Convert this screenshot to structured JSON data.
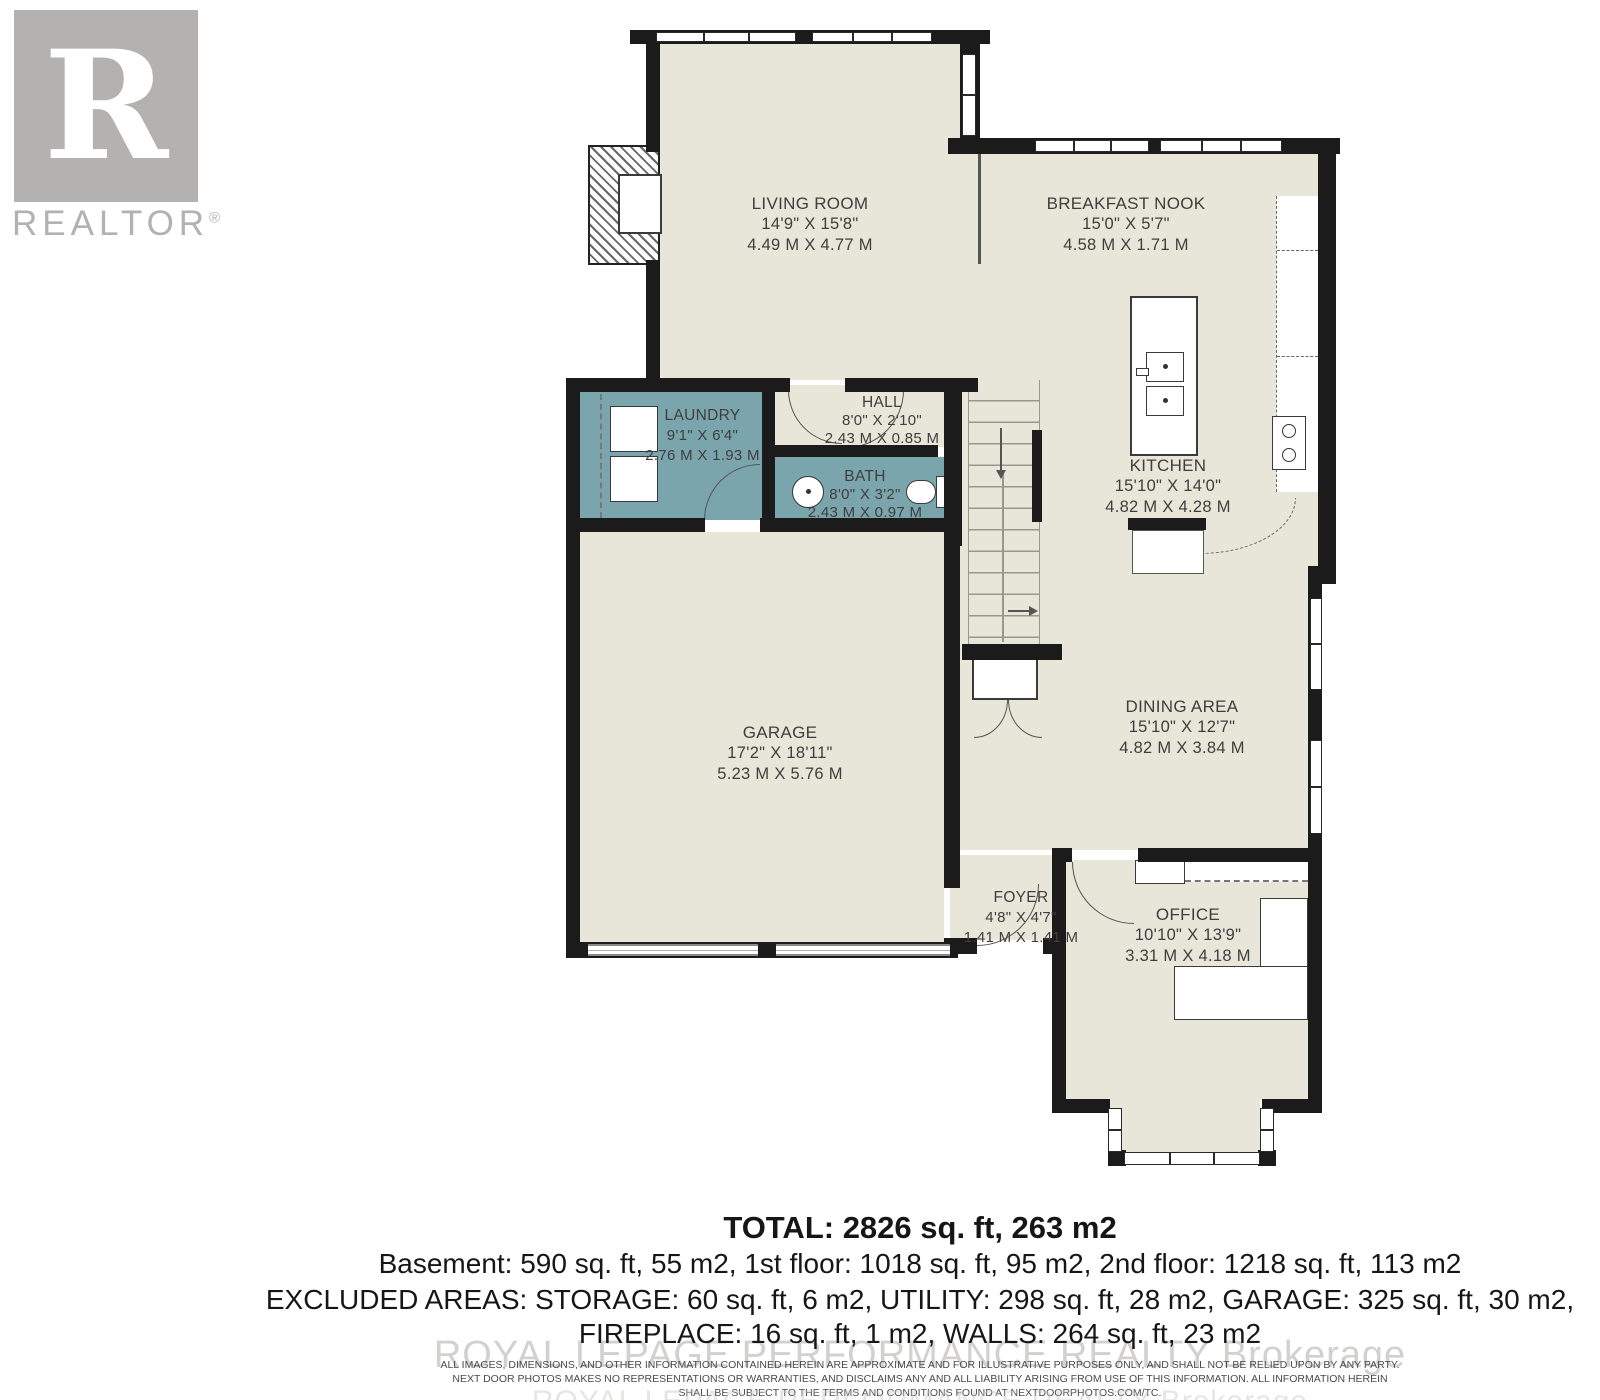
{
  "branding": {
    "logo_letter": "R",
    "logo_label": "REALTOR",
    "logo_reg": "®"
  },
  "rooms": [
    {
      "id": "living-room",
      "name": "LIVING ROOM",
      "imperial": "14'9\" X 15'8\"",
      "metric": "4.49 M X 4.77 M"
    },
    {
      "id": "breakfast-nook",
      "name": "BREAKFAST NOOK",
      "imperial": "15'0\" X 5'7\"",
      "metric": "4.58 M X 1.71 M"
    },
    {
      "id": "laundry",
      "name": "LAUNDRY",
      "imperial": "9'1\" X 6'4\"",
      "metric": "2.76 M X 1.93 M"
    },
    {
      "id": "hall",
      "name": "HALL",
      "imperial": "8'0\" X 2'10\"",
      "metric": "2.43 M X 0.85 M"
    },
    {
      "id": "bath",
      "name": "BATH",
      "imperial": "8'0\" X 3'2\"",
      "metric": "2.43 M X 0.97 M"
    },
    {
      "id": "kitchen",
      "name": "KITCHEN",
      "imperial": "15'10\" X 14'0\"",
      "metric": "4.82 M X 4.28 M"
    },
    {
      "id": "garage",
      "name": "GARAGE",
      "imperial": "17'2\" X 18'11\"",
      "metric": "5.23 M X 5.76 M"
    },
    {
      "id": "dining-area",
      "name": "DINING AREA",
      "imperial": "15'10\" X 12'7\"",
      "metric": "4.82 M X 3.84 M"
    },
    {
      "id": "foyer",
      "name": "FOYER",
      "imperial": "4'8\" X 4'7\"",
      "metric": "1.41 M X 1.41 M"
    },
    {
      "id": "office",
      "name": "OFFICE",
      "imperial": "10'10\" X 13'9\"",
      "metric": "3.31 M X 4.18 M"
    }
  ],
  "summary": {
    "total": "TOTAL: 2826 sq. ft, 263 m2",
    "floors": "Basement: 590 sq. ft, 55 m2, 1st floor: 1018 sq. ft, 95 m2, 2nd floor: 1218 sq. ft, 113 m2",
    "excluded_line1": "EXCLUDED AREAS: STORAGE: 60 sq. ft, 6 m2, UTILITY: 298 sq. ft, 28 m2, GARAGE: 325 sq. ft, 30 m2,",
    "excluded_line2": "FIREPLACE: 16 sq. ft, 1 m2, WALLS: 264 sq. ft, 23 m2"
  },
  "watermark": "ROYAL LEPAGE PERFORMANCE REALTY Brokerage",
  "disclaimer": {
    "line1": "ALL IMAGES, DIMENSIONS, AND OTHER INFORMATION CONTAINED HEREIN ARE APPROXIMATE AND FOR ILLUSTRATIVE PURPOSES ONLY, AND SHALL NOT BE RELIED UPON BY ANY PARTY.",
    "line2": "NEXT DOOR PHOTOS MAKES NO REPRESENTATIONS OR WARRANTIES, AND DISCLAIMS ANY AND ALL LIABILITY ARISING FROM USE OF THIS INFORMATION. ALL INFORMATION HEREIN",
    "line3": "SHALL BE SUBJECT TO THE TERMS AND CONDITIONS FOUND AT NEXTDOORPHOTOS.COM/TC."
  },
  "colors": {
    "wall": "#1b1b1b",
    "floor": "#e7e6d9",
    "wet_room": "#7ba5ad",
    "label": "#3e3e3e",
    "logo": "#b3b2b0"
  }
}
